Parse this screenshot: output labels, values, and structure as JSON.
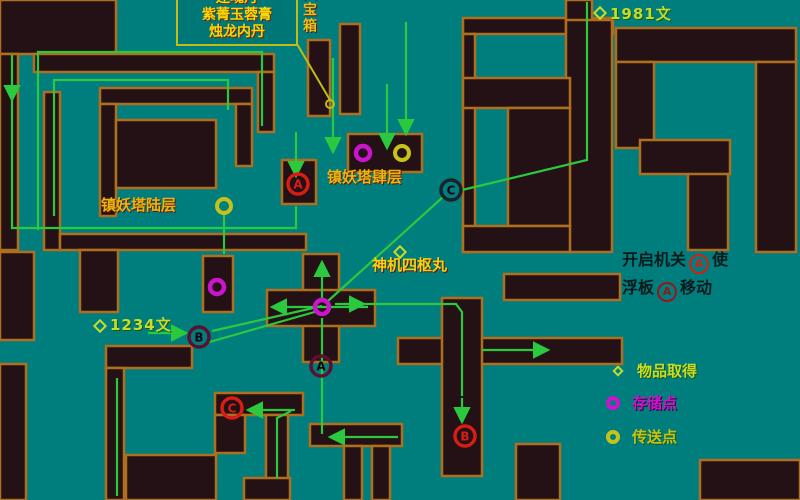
{
  "colors": {
    "background": "#007e7e",
    "wall_fill": "#231116",
    "wall_border": "#b06f1c",
    "route_green": "#2bc93e",
    "pointer_yellow": "#c2bc16",
    "label_yellow": "#f5d908",
    "label_orange": "#c8821a",
    "money_green_yellow": "#c6dc28",
    "save_magenta": "#cc14cc",
    "teleport_yellow": "#c6c218",
    "mechanism_red": "#d81d14",
    "board_dark_red": "#5c1030",
    "board_black": "#1b2228",
    "instruction_black": "#0c1a1c"
  },
  "annotation_box": {
    "lines": [
      "还魂丹",
      "紫菁玉蓉膏",
      "烛龙内丹"
    ]
  },
  "chest_label": "大宝箱",
  "labels": [
    {
      "id": "money-1981",
      "text": "1981文"
    },
    {
      "id": "tower-floor-6",
      "text": "镇妖塔陆层"
    },
    {
      "id": "tower-floor-4",
      "text": "镇妖塔肆层"
    },
    {
      "id": "item-shenji",
      "text": "神机四枢丸"
    },
    {
      "id": "money-1234",
      "text": "1234文"
    }
  ],
  "instruction": {
    "l1a": "开启机关",
    "l1m": "A",
    "l1b": "使",
    "l2a": "浮板",
    "l2m": "A",
    "l2b": "移动"
  },
  "legend": {
    "items": [
      {
        "symbol": "diamond-yellow",
        "label": "物品取得"
      },
      {
        "symbol": "circle-magenta",
        "label": "存储点"
      },
      {
        "symbol": "circle-yellow",
        "label": "传送点"
      }
    ]
  },
  "map": {
    "walls": [
      [
        0,
        0,
        116,
        54
      ],
      [
        34,
        54,
        240,
        18
      ],
      [
        258,
        72,
        16,
        60
      ],
      [
        0,
        54,
        18,
        196
      ],
      [
        44,
        92,
        16,
        158
      ],
      [
        100,
        88,
        152,
        16
      ],
      [
        236,
        104,
        16,
        62
      ],
      [
        100,
        104,
        16,
        112
      ],
      [
        116,
        120,
        100,
        68
      ],
      [
        60,
        234,
        246,
        16
      ],
      [
        308,
        40,
        22,
        76
      ],
      [
        340,
        24,
        20,
        90
      ],
      [
        282,
        160,
        34,
        44
      ],
      [
        348,
        134,
        74,
        38
      ],
      [
        463,
        18,
        150,
        16
      ],
      [
        566,
        0,
        26,
        36
      ],
      [
        566,
        20,
        46,
        232
      ],
      [
        463,
        34,
        12,
        218
      ],
      [
        463,
        78,
        107,
        30
      ],
      [
        508,
        108,
        62,
        118
      ],
      [
        463,
        226,
        107,
        26
      ],
      [
        616,
        28,
        180,
        34
      ],
      [
        616,
        62,
        38,
        86
      ],
      [
        756,
        62,
        40,
        190
      ],
      [
        688,
        150,
        40,
        100
      ],
      [
        640,
        140,
        90,
        34
      ],
      [
        504,
        274,
        116,
        26
      ],
      [
        398,
        338,
        224,
        26
      ],
      [
        442,
        298,
        40,
        178
      ],
      [
        303,
        254,
        36,
        108
      ],
      [
        267,
        290,
        108,
        36
      ],
      [
        80,
        250,
        38,
        62
      ],
      [
        0,
        252,
        34,
        88
      ],
      [
        0,
        364,
        26,
        136
      ],
      [
        203,
        256,
        30,
        56
      ],
      [
        106,
        346,
        86,
        22
      ],
      [
        106,
        368,
        18,
        132
      ],
      [
        215,
        393,
        88,
        22
      ],
      [
        215,
        415,
        30,
        38
      ],
      [
        266,
        415,
        22,
        66
      ],
      [
        244,
        478,
        46,
        22
      ],
      [
        126,
        455,
        90,
        45
      ],
      [
        310,
        424,
        92,
        22
      ],
      [
        344,
        446,
        18,
        54
      ],
      [
        372,
        446,
        18,
        54
      ],
      [
        516,
        444,
        44,
        56
      ],
      [
        700,
        460,
        100,
        40
      ]
    ],
    "pointer_line": [
      [
        297,
        44
      ],
      [
        330,
        100
      ]
    ],
    "paths": [
      {
        "pts": [
          [
            12,
            55
          ],
          [
            12,
            98
          ]
        ],
        "arrow": true
      },
      {
        "pts": [
          [
            12,
            98
          ],
          [
            12,
            228
          ],
          [
            296,
            228
          ],
          [
            296,
            206
          ]
        ],
        "arrow": false
      },
      {
        "pts": [
          [
            38,
            230
          ],
          [
            38,
            52
          ],
          [
            262,
            52
          ],
          [
            262,
            126
          ]
        ],
        "arrow": false
      },
      {
        "pts": [
          [
            54,
            216
          ],
          [
            54,
            80
          ],
          [
            228,
            80
          ],
          [
            228,
            110
          ]
        ],
        "arrow": false
      },
      {
        "pts": [
          [
            333,
            58
          ],
          [
            333,
            150
          ]
        ],
        "arrow": true
      },
      {
        "pts": [
          [
            387,
            84
          ],
          [
            387,
            146
          ]
        ],
        "arrow": true
      },
      {
        "pts": [
          [
            296,
            132
          ],
          [
            296,
            174
          ]
        ],
        "arrow": true
      },
      {
        "pts": [
          [
            406,
            22
          ],
          [
            406,
            132
          ]
        ],
        "arrow": true
      },
      {
        "pts": [
          [
            587,
            2
          ],
          [
            587,
            160
          ],
          [
            462,
            190
          ]
        ],
        "arrow": false
      },
      {
        "pts": [
          [
            443,
            197
          ],
          [
            328,
            301
          ]
        ],
        "arrow": false
      },
      {
        "pts": [
          [
            322,
            298
          ],
          [
            322,
            264
          ]
        ],
        "arrow": true
      },
      {
        "pts": [
          [
            322,
            318
          ],
          [
            322,
            434
          ]
        ],
        "arrow": false
      },
      {
        "pts": [
          [
            398,
            437
          ],
          [
            332,
            437
          ]
        ],
        "arrow": true
      },
      {
        "pts": [
          [
            368,
            307
          ],
          [
            274,
            307
          ]
        ],
        "arrow": true
      },
      {
        "pts": [
          [
            335,
            304
          ],
          [
            456,
            304
          ],
          [
            462,
            312
          ],
          [
            462,
            396
          ]
        ],
        "arrow": false
      },
      {
        "pts": [
          [
            344,
            304
          ],
          [
            362,
            304
          ]
        ],
        "arrow": true
      },
      {
        "pts": [
          [
            462,
            398
          ],
          [
            462,
            420
          ]
        ],
        "arrow": true
      },
      {
        "pts": [
          [
            322,
            306
          ],
          [
            212,
            331
          ]
        ],
        "arrow": false
      },
      {
        "pts": [
          [
            206,
            343
          ],
          [
            318,
            311
          ]
        ],
        "arrow": false
      },
      {
        "pts": [
          [
            148,
            333
          ],
          [
            184,
            333
          ]
        ],
        "arrow": true
      },
      {
        "pts": [
          [
            224,
            214
          ],
          [
            224,
            254
          ]
        ],
        "arrow": false
      },
      {
        "pts": [
          [
            482,
            350
          ],
          [
            546,
            350
          ]
        ],
        "arrow": true
      },
      {
        "pts": [
          [
            295,
            410
          ],
          [
            250,
            410
          ]
        ],
        "arrow": true
      },
      {
        "pts": [
          [
            277,
            478
          ],
          [
            277,
            418
          ],
          [
            291,
            411
          ]
        ],
        "arrow": false
      },
      {
        "pts": [
          [
            117,
            378
          ],
          [
            117,
            496
          ]
        ],
        "arrow": false
      }
    ],
    "markers": [
      {
        "letter": "A",
        "kind": "mech",
        "x": 298,
        "y": 184
      },
      {
        "letter": "B",
        "kind": "mech",
        "x": 465,
        "y": 436
      },
      {
        "letter": "C",
        "kind": "mech",
        "x": 232,
        "y": 408
      },
      {
        "letter": "A",
        "kind": "board",
        "x": 321,
        "y": 366
      },
      {
        "letter": "B",
        "kind": "board",
        "x": 199,
        "y": 337
      },
      {
        "letter": "C",
        "kind": "boardc",
        "x": 451,
        "y": 190
      }
    ],
    "save_points": [
      [
        322,
        307
      ],
      [
        363,
        153
      ],
      [
        217,
        287
      ]
    ],
    "teleport_points": [
      [
        224,
        206
      ],
      [
        402,
        153
      ]
    ],
    "treasure_spot": [
      330,
      104
    ],
    "item_diamonds": [
      [
        600,
        13
      ],
      [
        100,
        326
      ],
      [
        400,
        252
      ]
    ]
  }
}
